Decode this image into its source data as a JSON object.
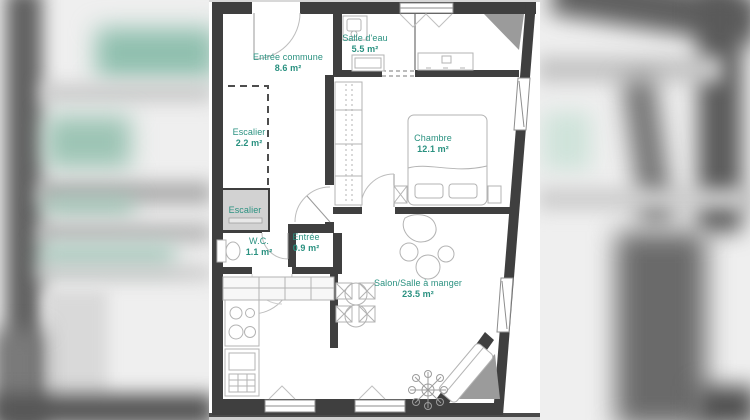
{
  "floor_plan": {
    "rooms": [
      {
        "name": "Entrée commune",
        "area": "8.6 m²"
      },
      {
        "name": "Salle d'eau",
        "area": "5.5 m²"
      },
      {
        "name": "Escalier",
        "area": "2.2 m²"
      },
      {
        "name": "Chambre",
        "area": "12.1 m²"
      },
      {
        "name": "Escalier",
        "area": ""
      },
      {
        "name": "W.C.",
        "area": "1.1 m²"
      },
      {
        "name": "Entrée",
        "area": "0.9 m²"
      },
      {
        "name": "Salon/Salle à manger",
        "area": "23.5 m²"
      }
    ],
    "colors": {
      "wall": "#3f3f3f",
      "label": "#2a9180",
      "corner_fill": "#9b9b9b",
      "stair_box_fill": "#d2d2d2",
      "furniture_stroke": "#b3b3b3"
    }
  }
}
